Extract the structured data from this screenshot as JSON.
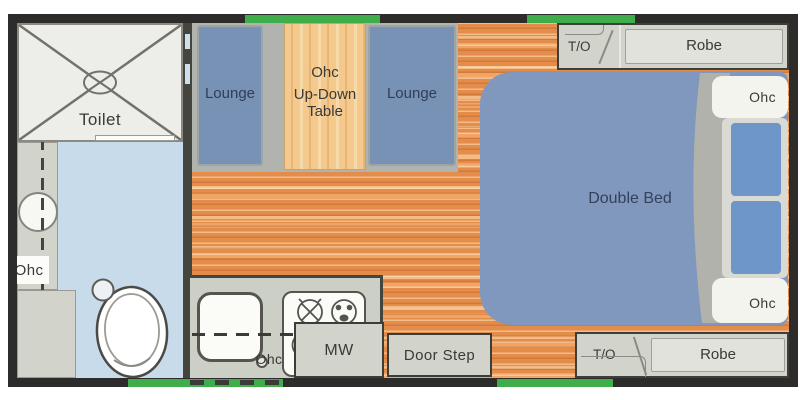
{
  "palette": {
    "wall": "#2d2c2a",
    "green": "#3fae4a",
    "wood": "#e48c4a",
    "wood-light": "#f0a466",
    "wood-pale": "#f6bb85",
    "table-wood": "#f4c98e",
    "table-wood-dark": "#eab572",
    "seat-blue": "#7892b6",
    "bed-blue": "#8198be",
    "pillow-blue": "#6f96c8",
    "bath-floor": "#c8dbea",
    "cabinet": "#d2d4cc",
    "cabinet-panel": "#e0e2db",
    "counter": "#cbcfc6",
    "shower": "#edede9",
    "base-gray": "#b1b4ae",
    "ink": "#3a3a35"
  },
  "bathroom": {
    "shower_label": "Toilet",
    "ohc_label": "Ohc"
  },
  "dinette": {
    "lounge_left": "Lounge",
    "lounge_right": "Lounge",
    "table_line1": "Ohc",
    "table_line2": "Up-Down",
    "table_line3": "Table"
  },
  "bedroom": {
    "bed_label": "Double Bed",
    "ohc_top": "Ohc",
    "ohc_bottom": "Ohc",
    "top_cabinet": {
      "to": "T/O",
      "robe": "Robe"
    },
    "bottom_cabinet": {
      "to": "T/O",
      "robe": "Robe"
    }
  },
  "kitchen": {
    "ohc_label": "Ohc",
    "microwave": "MW",
    "door_step": "Door Step"
  }
}
